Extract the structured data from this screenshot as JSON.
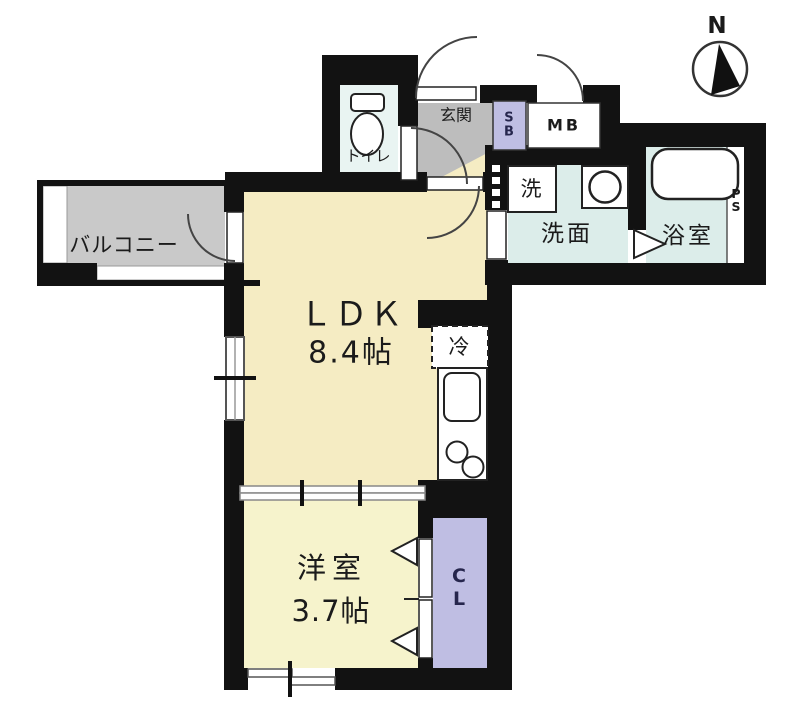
{
  "compass": {
    "north": "N"
  },
  "rooms": {
    "balcony": {
      "label": "バルコニー"
    },
    "ldk": {
      "label": "ＬＤＫ",
      "size": "8.4帖"
    },
    "western": {
      "label": "洋室",
      "size": "3.7帖"
    },
    "toilet": {
      "label": "トイレ"
    },
    "entrance": {
      "label": "玄関"
    },
    "washroom": {
      "label": "洗面"
    },
    "bathroom": {
      "label": "浴室"
    }
  },
  "fixtures": {
    "shoe_box": {
      "line1": "S",
      "line2": "B"
    },
    "meter_box": {
      "label": "MB"
    },
    "washing_machine": {
      "label": "洗"
    },
    "pipe_space": {
      "line1": "P",
      "line2": "S"
    },
    "refrigerator": {
      "label": "冷"
    },
    "closet": {
      "line1": "C",
      "line2": "L"
    }
  },
  "colors": {
    "wall": "#121212",
    "ldk_floor": "#f5ecc3",
    "western_floor": "#f6f3cc",
    "wet_floor": "#dcedea",
    "toilet_floor": "#e9f4f2",
    "entrance_floor": "#bdbdbd",
    "balcony_floor": "#c9c9c9",
    "closet_fill": "#bfbee3",
    "outline": "#222222"
  }
}
